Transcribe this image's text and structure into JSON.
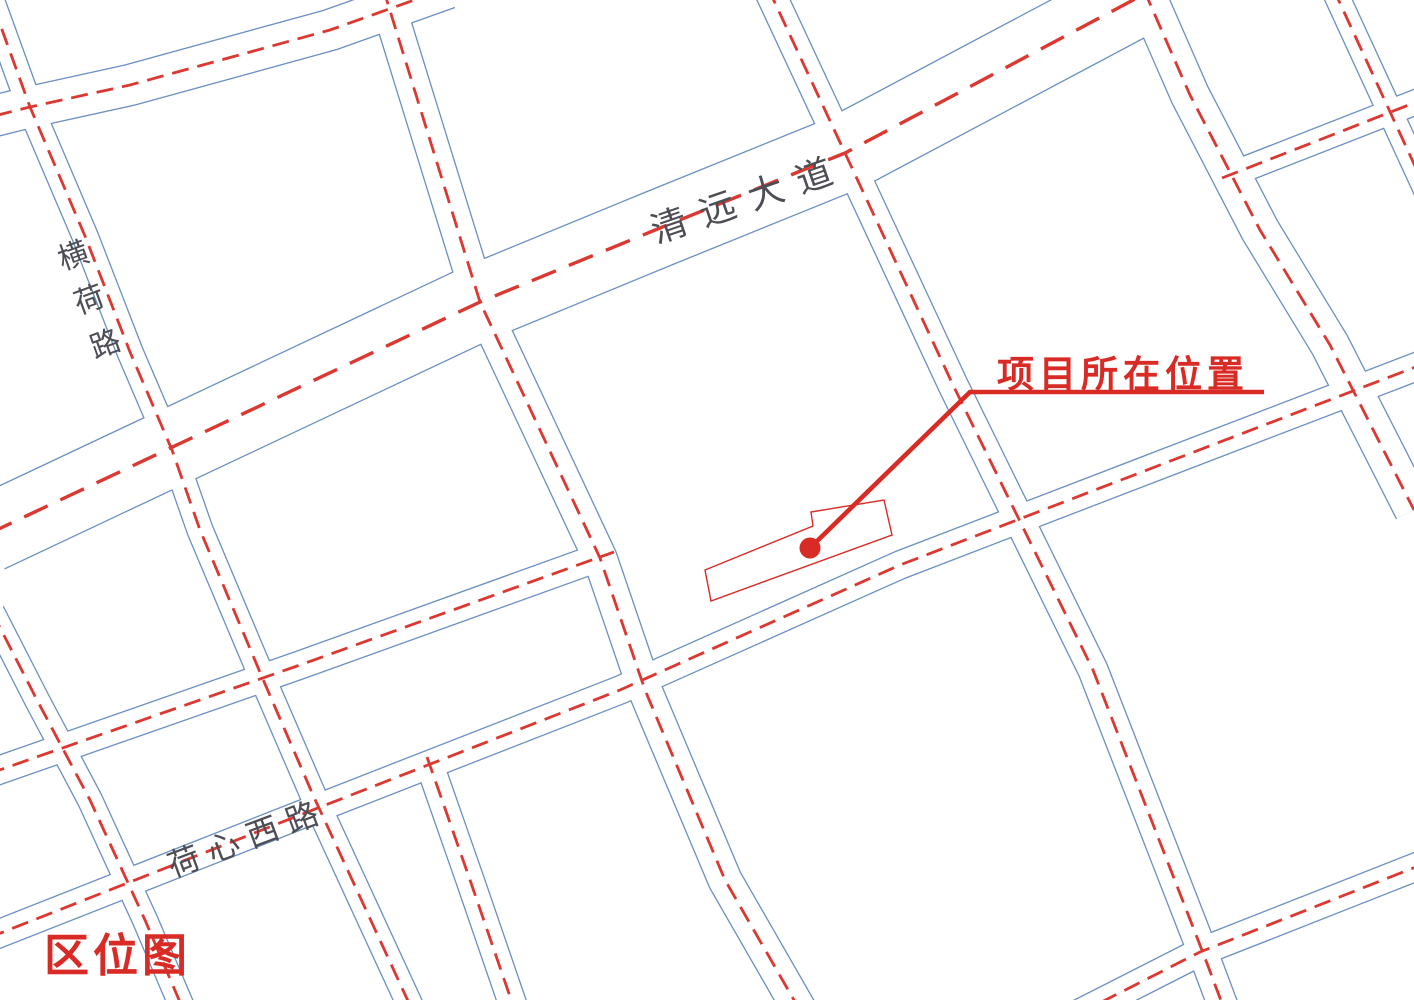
{
  "map": {
    "legend_title": "区位图",
    "road_labels": {
      "qingyuan_avenue": "清远大道",
      "henghe_road": "横荷路",
      "hexin_west_road": "荷心西路"
    },
    "annotation": {
      "project_location_label": "项目所在位置"
    },
    "colors": {
      "background": "#ffffff",
      "road_edge_blue": "#6a8fc2",
      "centerline_red": "#dc3832",
      "annotation_red": "#d92b26",
      "road_text_gray": "#4d4d56",
      "border_gray": "#3c3c3c"
    }
  }
}
